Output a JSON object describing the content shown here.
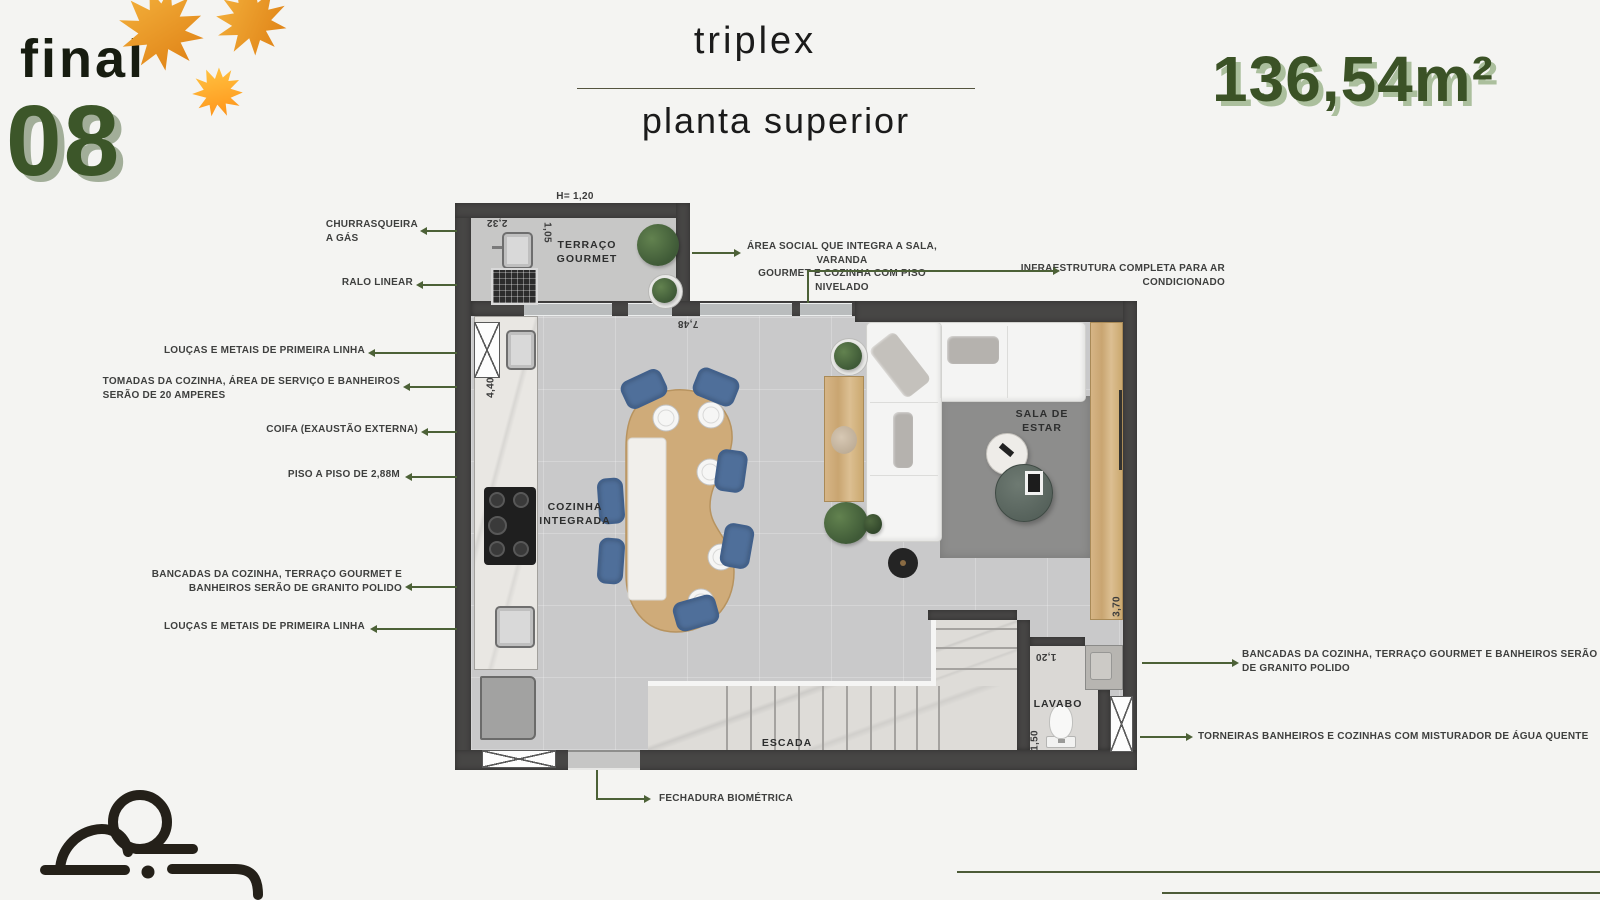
{
  "header": {
    "unit_prefix": "final",
    "unit_number": "08",
    "title": "triplex",
    "subtitle": "planta superior",
    "area": "136,54m²"
  },
  "plan": {
    "rooms": {
      "terrace": "TERRAÇO\nGOURMET",
      "kitchen": "COZINHA\nINTEGRADA",
      "living": "SALA DE\nESTAR",
      "stairs": "ESCADA",
      "bathroom": "LAVABO"
    },
    "dimensions": {
      "ceiling": "H= 1,20",
      "terrace_depth": "2,32",
      "terrace_side": "1,05",
      "living_width": "7,48",
      "kitchen_length": "4,40",
      "panel_length": "3,70",
      "bathroom_width": "1,20",
      "bathroom_depth": "1,50"
    }
  },
  "annotations": {
    "left": [
      {
        "label": "CHURRASQUEIRA\nA GÁS"
      },
      {
        "label": "RALO LINEAR"
      },
      {
        "label": "LOUÇAS E METAIS DE PRIMEIRA LINHA"
      },
      {
        "label": "TOMADAS DA COZINHA, ÁREA DE SERVIÇO E BANHEIROS\nSERÃO DE 20 AMPERES"
      },
      {
        "label": "COIFA (EXAUSTÃO EXTERNA)"
      },
      {
        "label": "PISO A  PISO DE 2,88M"
      },
      {
        "label": "BANCADAS DA COZINHA, TERRAÇO GOURMET E\nBANHEIROS SERÃO DE GRANITO POLIDO"
      },
      {
        "label": "LOUÇAS E METAIS DE PRIMEIRA LINHA"
      }
    ],
    "right": [
      {
        "label": "ÁREA SOCIAL QUE INTEGRA A SALA, VARANDA\nGOURMET E COZINHA COM PISO NIVELADO"
      },
      {
        "label": "INFRAESTRUTURA COMPLETA PARA AR\nCONDICIONADO"
      },
      {
        "label": "BANCADAS DA COZINHA, TERRAÇO GOURMET E BANHEIROS SERÃO\nDE GRANITO POLIDO"
      },
      {
        "label": "TORNEIRAS BANHEIROS E COZINHAS COM MISTURADOR DE ÁGUA QUENTE"
      }
    ],
    "bottom": [
      {
        "label": "FECHADURA BIOMÉTRICA"
      }
    ]
  },
  "colors": {
    "accent_green": "#3c5629",
    "shadow_green": "#a2ae99",
    "leaf_orange": "#e8922a",
    "annotation_line": "#4c6137",
    "wall_gray": "#474645",
    "wood": "#cfab79",
    "chair_blue": "#4f6f9a"
  }
}
